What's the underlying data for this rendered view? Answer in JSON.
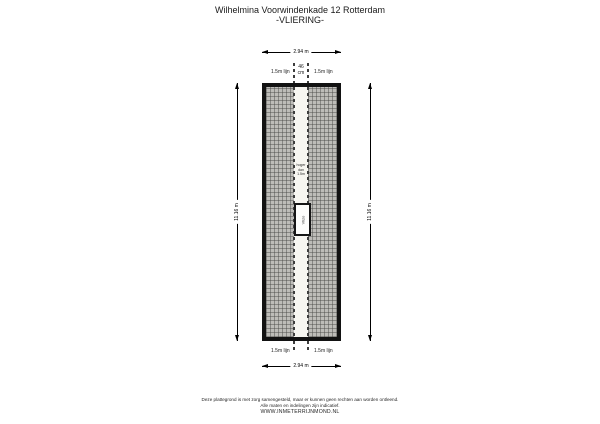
{
  "title": {
    "line1": "Wilhelmina Voorwindenkade 12 Rotterdam",
    "line2": "-VLIERING-"
  },
  "dimensions": {
    "top": "2.94 m",
    "bottom": "2.94 m",
    "left": "11.16 m",
    "right": "11.16 m",
    "center_width_value": "46",
    "center_width_unit": "cm"
  },
  "height_lines": {
    "top_left": "1.5m lijn",
    "top_right": "1.5m lijn",
    "bottom_left": "1.5m lijn",
    "bottom_right": "1.5m lijn"
  },
  "room": {
    "strip_note_line1": "hoger",
    "strip_note_line2": "dan",
    "strip_note_line3": "1.5m",
    "hatch_object_label": "Vlizo"
  },
  "footer": {
    "line1": "Deze plattegrond is met zorg samengesteld, maar er kunnen geen rechten aan worden ontleend.",
    "line2": "Alle maten en indelingen zijn indicatief.",
    "line3": "WWW.INMETERRIJNMOND.NL"
  },
  "colors": {
    "wall": "#121212",
    "hatch_fill": "#bdbcb8",
    "hatch_line": "#6f6f6d",
    "dash_line": "#3d3d3d",
    "background": "#ffffff"
  }
}
